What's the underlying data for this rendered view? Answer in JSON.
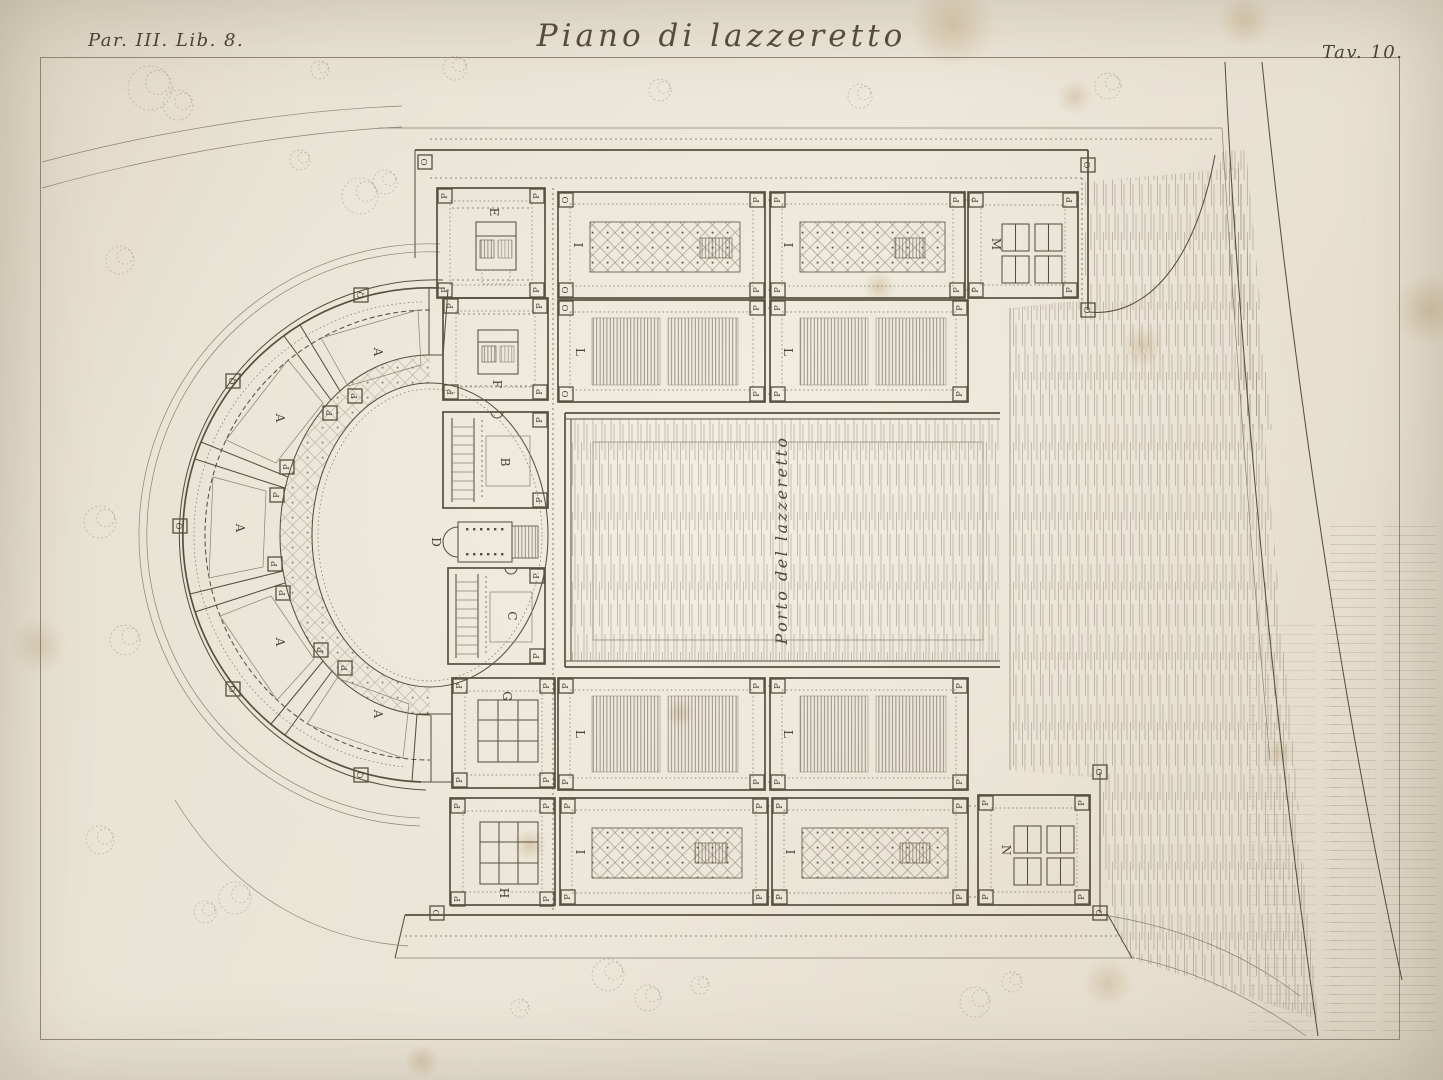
{
  "plate": {
    "heading_left": "Par. III. Lib. 8.",
    "title": "Piano di lazzeretto",
    "heading_right": "Tav. 10.",
    "port_label": "Porto del lazzeretto",
    "room_labels": {
      "A": "A",
      "B": "B",
      "C": "C",
      "D": "D",
      "E": "E",
      "F": "F",
      "G": "G",
      "H": "H",
      "I": "I",
      "L": "L",
      "M": "M",
      "N": "N"
    },
    "marker_labels": {
      "P": "P",
      "Q": "Q",
      "O": "O"
    },
    "ink_color": "#57503f",
    "paper_color": "#e9e3d4"
  }
}
